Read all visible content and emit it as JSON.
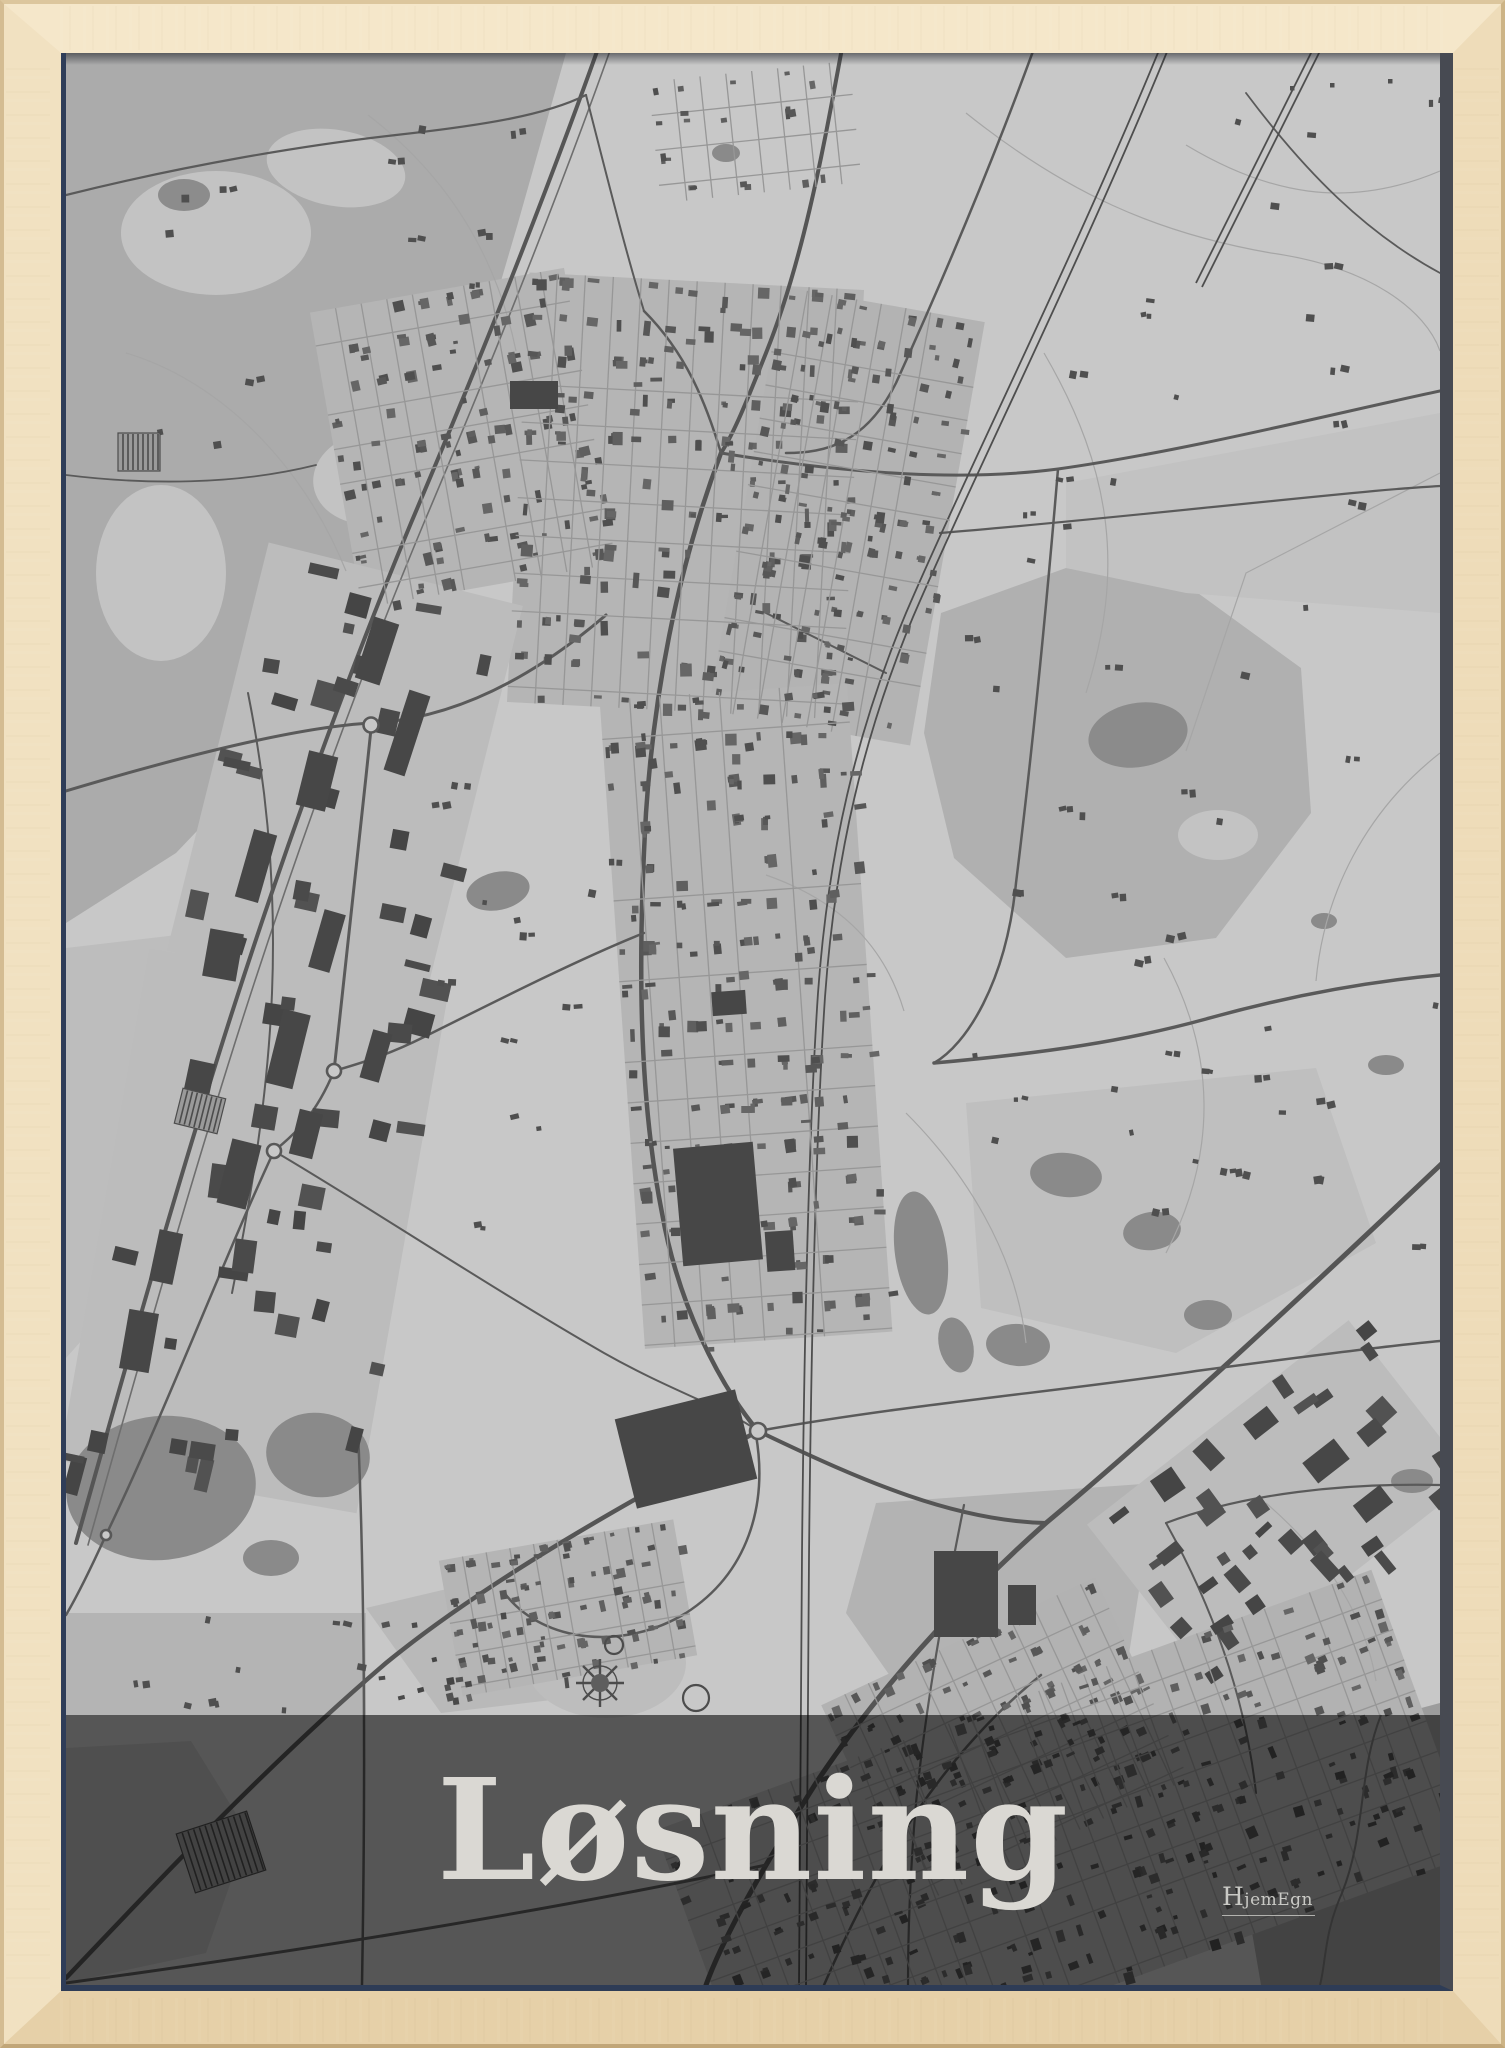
{
  "poster": {
    "title": "Løsning",
    "brand": "HjemEgn"
  },
  "colors": {
    "map_bg": "#c8c8c8",
    "road": "#5a5a5a",
    "road_major": "#555555",
    "rail": "#4e4e4e",
    "thin": "#a6a6a6",
    "grid_street": "#979797",
    "building_palette": [
      "#5f5f5f",
      "#575757",
      "#4f4f4f",
      "#666666"
    ],
    "industrial_palette": [
      "#4a4a4a",
      "#454545",
      "#525252"
    ],
    "overlay": "#000000",
    "title_text": "#dad8d3",
    "frame_wood": "#f1e1c1",
    "frame_lip_blue": "#2f3d58",
    "frame_lip_slate": "#474a52"
  },
  "map": {
    "width": 1374,
    "height": 1932,
    "bg": "#c8c8c8",
    "areas": [
      {
        "type": "poly",
        "fill": "#ababab",
        "pts": "0,0 500,0 452,170 408,320 320,540 215,690 110,800 0,870"
      },
      {
        "type": "ellipse",
        "fill": "#c3c3c3",
        "cx": 150,
        "cy": 180,
        "rx": 95,
        "ry": 62,
        "rot": 0
      },
      {
        "type": "ellipse",
        "fill": "#c3c3c3",
        "cx": 270,
        "cy": 115,
        "rx": 70,
        "ry": 38,
        "rot": 10
      },
      {
        "type": "ellipse",
        "fill": "#c3c3c3",
        "cx": 95,
        "cy": 520,
        "rx": 65,
        "ry": 88,
        "rot": 0
      },
      {
        "type": "ellipse",
        "fill": "#c3c3c3",
        "cx": 305,
        "cy": 425,
        "rx": 58,
        "ry": 46,
        "rot": -8
      },
      {
        "type": "ellipse",
        "fill": "#8c8c8c",
        "cx": 118,
        "cy": 142,
        "rx": 26,
        "ry": 16,
        "rot": 0
      },
      {
        "type": "ellipse",
        "fill": "#8c8c8c",
        "cx": 215,
        "cy": 555,
        "rx": 18,
        "ry": 12,
        "rot": 0
      },
      {
        "type": "poly",
        "fill": "#b0b0b0",
        "pts": "875,560 1000,515 1125,535 1235,615 1245,760 1150,885 1000,905 888,805 858,680"
      },
      {
        "type": "ellipse",
        "fill": "#8b8b8b",
        "cx": 1072,
        "cy": 682,
        "rx": 50,
        "ry": 32,
        "rot": -10
      },
      {
        "type": "ellipse",
        "fill": "#c3c3c3",
        "cx": 1152,
        "cy": 782,
        "rx": 40,
        "ry": 25,
        "rot": 0
      },
      {
        "type": "poly",
        "fill": "#c2c2c2",
        "pts": "1000,430 1374,360 1374,560 1120,540 1000,515"
      },
      {
        "type": "poly",
        "fill": "#bfbfbf",
        "pts": "900,1050 1250,1015 1310,1190 1110,1300 915,1255"
      },
      {
        "type": "poly",
        "fill": "#b3b3b3",
        "pts": "810,1450 1090,1430 1060,1620 850,1660 780,1560"
      },
      {
        "type": "poly",
        "fill": "#9c9c9c",
        "pts": "1225,1690 1374,1650 1374,1932 1195,1932 1175,1815"
      },
      {
        "type": "poly",
        "fill": "#bdbdbd",
        "pts": "0,895 145,878 122,1060 58,1240 0,1305"
      },
      {
        "type": "poly",
        "fill": "#b4b4b4",
        "pts": "0,1560 300,1560 300,1662 0,1662"
      },
      {
        "type": "poly",
        "fill": "#b9b9b9",
        "pts": "300,1555 470,1515 560,1555 545,1640 375,1660"
      },
      {
        "type": "poly",
        "fill": "#b7b7b7",
        "pts": "0,1695 125,1688 182,1780 140,1900 0,1930"
      },
      {
        "type": "ellipse",
        "fill": "#bdbdbd",
        "cx": 540,
        "cy": 1610,
        "rx": 80,
        "ry": 55,
        "rot": 0
      }
    ],
    "lakes": [
      {
        "cx": 855,
        "cy": 1200,
        "rx": 26,
        "ry": 62,
        "rot": -8
      },
      {
        "cx": 890,
        "cy": 1292,
        "rx": 17,
        "ry": 28,
        "rot": -14
      },
      {
        "cx": 95,
        "cy": 1435,
        "rx": 95,
        "ry": 72,
        "rot": -6
      },
      {
        "cx": 252,
        "cy": 1402,
        "rx": 52,
        "ry": 42,
        "rot": 8
      },
      {
        "cx": 205,
        "cy": 1505,
        "rx": 28,
        "ry": 18,
        "rot": 0
      },
      {
        "cx": 1320,
        "cy": 1012,
        "rx": 18,
        "ry": 10,
        "rot": 0
      },
      {
        "cx": 1258,
        "cy": 868,
        "rx": 13,
        "ry": 8,
        "rot": 0
      },
      {
        "cx": 1346,
        "cy": 1428,
        "rx": 21,
        "ry": 12,
        "rot": 0
      },
      {
        "cx": 432,
        "cy": 838,
        "rx": 32,
        "ry": 19,
        "rot": -12
      },
      {
        "cx": 1000,
        "cy": 1122,
        "rx": 36,
        "ry": 22,
        "rot": 6
      },
      {
        "cx": 1086,
        "cy": 1178,
        "rx": 29,
        "ry": 19,
        "rot": -8
      },
      {
        "cx": 1142,
        "cy": 1262,
        "rx": 24,
        "ry": 15,
        "rot": 0
      },
      {
        "cx": 952,
        "cy": 1292,
        "rx": 32,
        "ry": 21,
        "rot": 4
      },
      {
        "cx": 660,
        "cy": 100,
        "rx": 14,
        "ry": 9,
        "rot": 0
      }
    ],
    "thin": [
      {
        "d": "M 900,60 C 1000,140 1090,180 1205,200 C 1305,214 1360,258 1374,298"
      },
      {
        "d": "M 1374,118 C 1280,158 1200,140 1120,92"
      },
      {
        "d": "M 978,300 C 1048,420 1058,520 1020,640"
      },
      {
        "d": "M 1098,905 C 1150,1000 1152,1100 1100,1200"
      },
      {
        "d": "M 1200,1450 C 1258,1500 1298,1558 1310,1628"
      },
      {
        "d": "M 302,62 C 380,122 430,200 450,298"
      },
      {
        "d": "M 60,300 C 160,330 240,418 280,518"
      },
      {
        "d": "M 1374,700 C 1300,758 1258,840 1250,928"
      },
      {
        "d": "M 700,822 C 780,850 820,898 838,958"
      },
      {
        "d": "M 1374,420 L 1180,520 L 1120,698"
      },
      {
        "d": "M 840,1060 C 900,1120 950,1200 960,1290"
      }
    ],
    "motorway": {
      "d": "M 534,-10 C 470,170 400,340 345,470 C 270,650 200,850 150,1010 C 100,1170 55,1330 10,1490",
      "d2": "M 546,-8 C 482,172 412,342 357,472 C 282,652 212,852 162,1012 C 112,1172 67,1332 22,1492"
    },
    "rails": [
      {
        "d": "M 1096,-10 C 1010,200 900,420 840,560 C 790,680 762,800 752,940 C 742,1090 738,1300 736,1500 C 735,1700 734,1850 733,1932"
      },
      {
        "d": "M 1103,-6 C 1017,204 907,424 847,564 C 797,684 769,804 759,944 C 749,1094 745,1304 743,1504 C 742,1704 741,1854 740,1932"
      },
      {
        "d": "M 1250,-10 L 1130,230"
      },
      {
        "d": "M 1256,-6 L 1136,234"
      }
    ],
    "roads": [
      {
        "d": "M 777,-10 C 760,80 740,200 700,300 C 680,350 668,380 655,400",
        "w": 4
      },
      {
        "d": "M 970,-10 C 930,100 880,220 830,330 C 800,390 760,400 720,400",
        "w": 2.5
      },
      {
        "d": "M 655,400 C 610,520 588,640 580,760 C 572,900 572,1040 596,1160 C 612,1250 652,1330 692,1378",
        "w": 4.5
      },
      {
        "d": "M 692,1378 C 580,1440 430,1520 320,1610 C 205,1708 90,1830 0,1925",
        "w": 4.5
      },
      {
        "d": "M 692,1378 C 800,1430 890,1468 980,1470",
        "w": 4
      },
      {
        "d": "M 1387,1100 C 1250,1230 1100,1370 980,1470 C 890,1550 810,1640 750,1730 C 690,1825 655,1890 640,1932",
        "w": 5
      },
      {
        "d": "M 692,1378 C 850,1350 1000,1338 1130,1318 C 1250,1302 1330,1292 1374,1288",
        "w": 2.5
      },
      {
        "d": "M 655,400 C 790,422 900,428 992,416 C 1120,398 1270,360 1374,338",
        "w": 3
      },
      {
        "d": "M 874,480 C 1000,470 1160,452 1308,438 C 1340,435 1360,434 1374,433",
        "w": 2.2
      },
      {
        "d": "M 868,1010 C 980,1000 1060,988 1140,966 C 1240,938 1320,927 1374,922",
        "w": 3.5
      },
      {
        "d": "M 992,416 C 980,560 966,700 950,830 C 940,930 900,992 868,1010",
        "w": 2.5
      },
      {
        "d": "M 0,738 C 120,702 232,674 305,670 C 390,666 470,622 540,562",
        "w": 3
      },
      {
        "d": "M 305,676 C 292,800 278,930 268,1018",
        "w": 3
      },
      {
        "d": "M 268,1018 C 250,1062 228,1082 208,1098",
        "w": 2.5
      },
      {
        "d": "M 208,1098 C 158,1205 98,1362 40,1482 C 25,1515 10,1545 0,1562",
        "w": 2.5
      },
      {
        "d": "M 578,880 C 515,905 430,948 358,984 C 318,1004 288,1012 268,1018",
        "w": 2.5
      },
      {
        "d": "M 208,1098 C 300,1152 420,1232 538,1300 C 605,1338 660,1355 692,1378",
        "w": 2
      },
      {
        "d": "M 292,1378 C 298,1520 300,1700 296,1932",
        "w": 2.5
      },
      {
        "d": "M 0,1930 C 250,1896 480,1858 700,1812",
        "w": 3
      },
      {
        "d": "M 758,1932 C 812,1808 876,1702 975,1622",
        "w": 2.5
      },
      {
        "d": "M 898,1452 C 878,1552 860,1650 850,1750 C 844,1820 842,1880 842,1932",
        "w": 2.2
      },
      {
        "d": "M 1374,1432 C 1280,1430 1180,1440 1100,1470",
        "w": 2.2
      },
      {
        "d": "M 0,142 C 120,112 240,92 330,82 C 420,72 480,62 520,42",
        "w": 2.2
      },
      {
        "d": "M 520,42 C 540,120 560,200 578,258",
        "w": 2
      },
      {
        "d": "M 182,640 C 202,740 210,840 206,940 C 202,1040 186,1140 166,1240",
        "w": 2
      },
      {
        "d": "M 0,422 C 80,432 170,432 250,412",
        "w": 1.8
      },
      {
        "d": "M 690,1382 C 702,1452 682,1520 620,1560 C 558,1598 478,1590 440,1542",
        "w": 2.5
      },
      {
        "d": "M 578,258 C 620,300 640,350 655,400",
        "w": 2.5
      },
      {
        "d": "M 700,560 C 740,580 780,600 820,620",
        "w": 2
      },
      {
        "d": "M 1100,1470 C 1150,1560 1180,1650 1190,1740",
        "w": 2
      },
      {
        "d": "M 1180,40 C 1240,120 1300,180 1374,220",
        "w": 1.8
      }
    ],
    "clusters": [
      {
        "x": 268,
        "y": 235,
        "w": 258,
        "h": 300,
        "rot": -10,
        "tint": "#b5b5b5",
        "grid": 26,
        "n": 110,
        "smin": 4,
        "smax": 11
      },
      {
        "x": 452,
        "y": 228,
        "w": 335,
        "h": 430,
        "rot": 3,
        "tint": "#b5b5b5",
        "grid": 28,
        "n": 175,
        "smin": 4,
        "smax": 12
      },
      {
        "x": 678,
        "y": 248,
        "w": 205,
        "h": 430,
        "rot": 10,
        "tint": "#b3b3b3",
        "grid": 25,
        "n": 150,
        "smin": 4,
        "smax": 9
      },
      {
        "x": 556,
        "y": 638,
        "w": 248,
        "h": 650,
        "rot": -4,
        "tint": "#b5b5b5",
        "grid": 30,
        "n": 235,
        "smin": 4,
        "smax": 12
      },
      {
        "x": 148,
        "y": 515,
        "w": 262,
        "h": 420,
        "rot": 14,
        "tint": "#bcbcbc",
        "grid": 0,
        "n": 26,
        "smin": 10,
        "smax": 30
      },
      {
        "x": 36,
        "y": 918,
        "w": 302,
        "h": 520,
        "rot": 10,
        "tint": "#bcbcbc",
        "grid": 0,
        "n": 30,
        "smin": 10,
        "smax": 32
      },
      {
        "x": 383,
        "y": 1486,
        "w": 238,
        "h": 138,
        "rot": -10,
        "tint": "#b5b5b5",
        "grid": 24,
        "n": 100,
        "smin": 4,
        "smax": 9
      },
      {
        "x": 1048,
        "y": 1348,
        "w": 332,
        "h": 202,
        "rot": -38,
        "tint": "#bcbcbc",
        "grid": 0,
        "n": 36,
        "smin": 8,
        "smax": 26
      },
      {
        "x": 788,
        "y": 1578,
        "w": 302,
        "h": 222,
        "rot": -25,
        "tint": "#b2b2b2",
        "grid": 26,
        "n": 115,
        "smin": 4,
        "smax": 10
      },
      {
        "x": 618,
        "y": 1638,
        "w": 762,
        "h": 302,
        "rot": -20,
        "tint": "#b2b2b2",
        "grid": 24,
        "n": 335,
        "smin": 4,
        "smax": 10
      },
      {
        "x": 588,
        "y": 18,
        "w": 202,
        "h": 122,
        "rot": -6,
        "tint": "",
        "grid": 26,
        "n": 22,
        "smin": 4,
        "smax": 9
      },
      {
        "x": 300,
        "y": 1556,
        "w": 152,
        "h": 92,
        "rot": -10,
        "tint": "",
        "grid": 0,
        "n": 16,
        "smin": 4,
        "smax": 8
      }
    ],
    "scatter": [
      {
        "x": 880,
        "y": 40,
        "w": 494,
        "h": 1200,
        "n": 40
      },
      {
        "x": 60,
        "y": 40,
        "w": 400,
        "h": 400,
        "n": 14
      },
      {
        "x": 340,
        "y": 700,
        "w": 240,
        "h": 480,
        "n": 16
      },
      {
        "x": 900,
        "y": 950,
        "w": 420,
        "h": 280,
        "n": 10
      },
      {
        "x": 60,
        "y": 1560,
        "w": 240,
        "h": 100,
        "n": 8
      }
    ],
    "buildings": [
      {
        "x": 612,
        "y": 1092,
        "w": 80,
        "h": 118,
        "rot": -5
      },
      {
        "x": 558,
        "y": 1350,
        "w": 124,
        "h": 92,
        "rot": -14
      },
      {
        "x": 868,
        "y": 1498,
        "w": 64,
        "h": 86,
        "rot": 0
      },
      {
        "x": 942,
        "y": 1532,
        "w": 28,
        "h": 40,
        "rot": 0
      },
      {
        "x": 444,
        "y": 328,
        "w": 48,
        "h": 28,
        "rot": 0
      },
      {
        "x": 298,
        "y": 566,
        "w": 26,
        "h": 64,
        "rot": 18
      },
      {
        "x": 330,
        "y": 638,
        "w": 22,
        "h": 84,
        "rot": 18
      },
      {
        "x": 236,
        "y": 700,
        "w": 30,
        "h": 56,
        "rot": 14
      },
      {
        "x": 178,
        "y": 778,
        "w": 24,
        "h": 70,
        "rot": 16
      },
      {
        "x": 140,
        "y": 878,
        "w": 34,
        "h": 48,
        "rot": 10
      },
      {
        "x": 250,
        "y": 858,
        "w": 22,
        "h": 60,
        "rot": 16
      },
      {
        "x": 208,
        "y": 958,
        "w": 28,
        "h": 76,
        "rot": 14
      },
      {
        "x": 118,
        "y": 1008,
        "w": 26,
        "h": 58,
        "rot": 12
      },
      {
        "x": 158,
        "y": 1088,
        "w": 30,
        "h": 66,
        "rot": 14
      },
      {
        "x": 88,
        "y": 1178,
        "w": 24,
        "h": 52,
        "rot": 12
      },
      {
        "x": 58,
        "y": 1258,
        "w": 30,
        "h": 60,
        "rot": 10
      },
      {
        "x": 228,
        "y": 1058,
        "w": 24,
        "h": 46,
        "rot": 14
      },
      {
        "x": 300,
        "y": 978,
        "w": 20,
        "h": 50,
        "rot": 16
      },
      {
        "x": 700,
        "y": 1178,
        "w": 28,
        "h": 40,
        "rot": -4
      },
      {
        "x": 646,
        "y": 938,
        "w": 34,
        "h": 24,
        "rot": -4
      },
      {
        "x": 1240,
        "y": 1395,
        "w": 40,
        "h": 26,
        "rot": -38
      },
      {
        "x": 1290,
        "y": 1440,
        "w": 34,
        "h": 22,
        "rot": -38
      },
      {
        "x": 1180,
        "y": 1360,
        "w": 30,
        "h": 20,
        "rot": -38
      }
    ],
    "striped": [
      {
        "x": 118,
        "y": 1768,
        "w": 74,
        "h": 62,
        "rot": -18,
        "step": 6
      },
      {
        "x": 112,
        "y": 1040,
        "w": 44,
        "h": 36,
        "rot": 14,
        "step": 5
      },
      {
        "x": 52,
        "y": 380,
        "w": 42,
        "h": 38,
        "rot": 0,
        "step": 5
      }
    ],
    "roundabouts": [
      {
        "cx": 305,
        "cy": 672,
        "r": 7.5
      },
      {
        "cx": 268,
        "cy": 1018,
        "r": 7
      },
      {
        "cx": 208,
        "cy": 1098,
        "r": 7
      },
      {
        "cx": 692,
        "cy": 1378,
        "r": 8
      },
      {
        "cx": 40,
        "cy": 1482,
        "r": 5
      }
    ],
    "rings": [
      {
        "cx": 548,
        "cy": 1592,
        "r": 9
      },
      {
        "cx": 630,
        "cy": 1645,
        "r": 13
      }
    ],
    "flower": {
      "cx": 534,
      "cy": 1630,
      "spokes": 8,
      "r": 24,
      "core": 9,
      "ring": 17
    },
    "dots": [
      {
        "x": 1224,
        "y": 33
      },
      {
        "x": 1264,
        "y": 30
      },
      {
        "x": 1322,
        "y": 26
      }
    ],
    "stream": {
      "d": "M 1315,1662 C 1292,1720 1300,1780 1276,1840 C 1258,1880 1260,1910 1254,1932"
    },
    "overlay": {
      "y": 1662,
      "h": 270,
      "opacity": 0.57
    }
  }
}
